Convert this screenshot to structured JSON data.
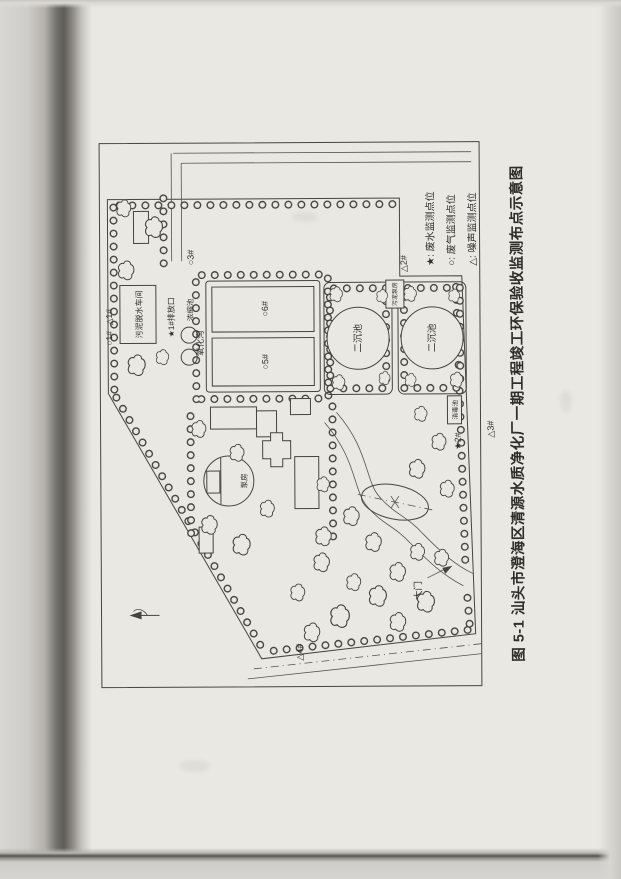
{
  "figure": {
    "caption": "图 5-1  汕头市澄海区清源水质净化厂一期工程竣工环保验收监测布点示意图",
    "legend": [
      {
        "text": "★: 废水监测点位"
      },
      {
        "text": "○: 废气监测点位"
      },
      {
        "text": "△: 噪声监测点位"
      }
    ],
    "facilities": {
      "oxidation_ditch": "氧化沟",
      "secondary_tank": "二沉池",
      "sludge_pump_house": "污泥泵房",
      "sludge_dewatering_workshop": "污泥脱水车间",
      "thickener": "浓缩池",
      "pump_house": "泵房",
      "disinfection_tank": "消毒池",
      "main_gate": "大门"
    },
    "monitoring_points": {
      "outfall_1": "★1#排放口",
      "wastewater_2": "★2#",
      "gas_1": "○1#",
      "gas_3": "○3#",
      "gas_5": "○5#",
      "gas_6": "○6#",
      "noise_1": "△1#",
      "noise_2": "△2#",
      "noise_3": "△3#",
      "noise_4": "△4#"
    }
  }
}
